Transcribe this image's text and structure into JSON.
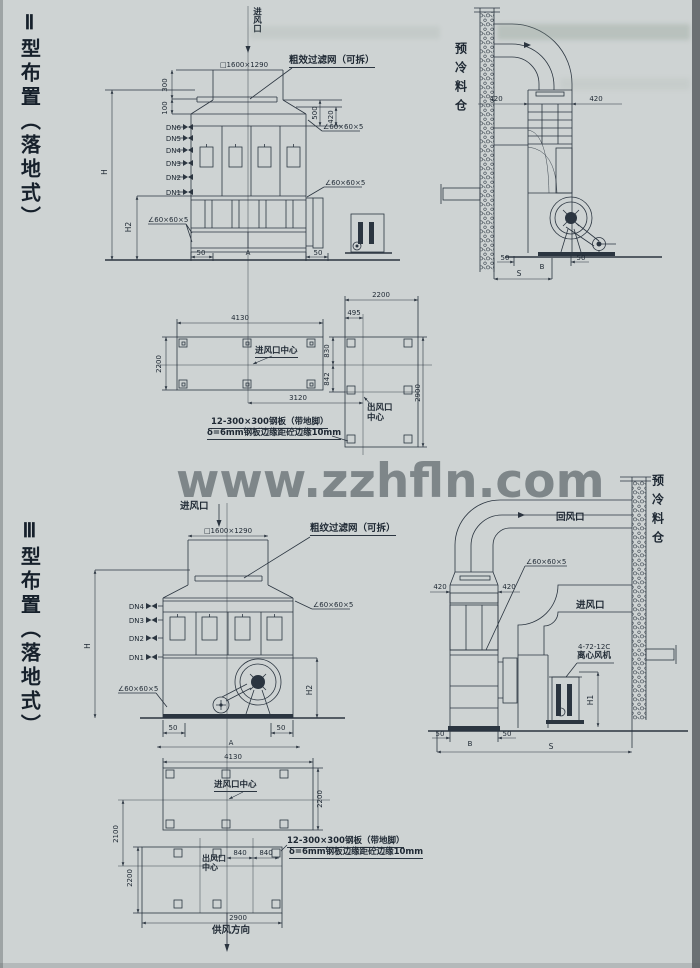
{
  "watermark": {
    "text": "www.zzhfln.com"
  },
  "common": {
    "angle_steel": "∠60×60×5",
    "inlet_size": "□1600×1290",
    "note_line1": "12-300×300钢板（带地脚）",
    "note_line2": "δ=6mm钢板边缘距砼边缘10mm",
    "silo_label": "预冷料仓",
    "inlet_label": "进风口"
  },
  "type2": {
    "title": "Ⅱ型布置（落地式）",
    "filter_label": "粗效过滤网（可拆）",
    "front": {
      "dims": {
        "d300": "300",
        "d100": "100",
        "d500": "500",
        "d420": "420",
        "H": "H",
        "H2": "H2",
        "d50": "50",
        "A": "A"
      },
      "nozzles": [
        "DN6",
        "DN5",
        "DN4",
        "DN3",
        "DN2",
        "DN1"
      ]
    },
    "side": {
      "d420": "420",
      "d50": "50",
      "B": "B",
      "S": "S"
    },
    "plan": {
      "d4130": "4130",
      "d2200": "2200",
      "d3120": "3120",
      "d495": "495",
      "d830": "830",
      "d842": "842",
      "d2900": "2900",
      "inlet_center": "进风口中心",
      "outlet_center_l1": "出风口",
      "outlet_center_l2": "中心"
    }
  },
  "type3": {
    "title": "Ⅲ型布置（落地式）",
    "filter_label": "粗纹过滤网（可拆）",
    "front": {
      "dims": {
        "H": "H",
        "H2": "H2",
        "d50": "50",
        "A": "A"
      },
      "nozzles": [
        "DN4",
        "DN3",
        "DN2",
        "DN1"
      ]
    },
    "side": {
      "d420": "420",
      "d50": "50",
      "B": "B",
      "S": "S",
      "H1": "H1",
      "return_air": "回风口",
      "inlet_air": "进风口",
      "fan_model": "4-72-12C",
      "fan_name": "离心风机"
    },
    "plan": {
      "d4130": "4130",
      "d2200": "2200",
      "d2100": "2100",
      "d840": "840",
      "d2900": "2900",
      "inlet_center": "进风口中心",
      "outlet_center_l1": "出风口",
      "outlet_center_l2": "中心",
      "supply_dir": "供风方向"
    }
  }
}
